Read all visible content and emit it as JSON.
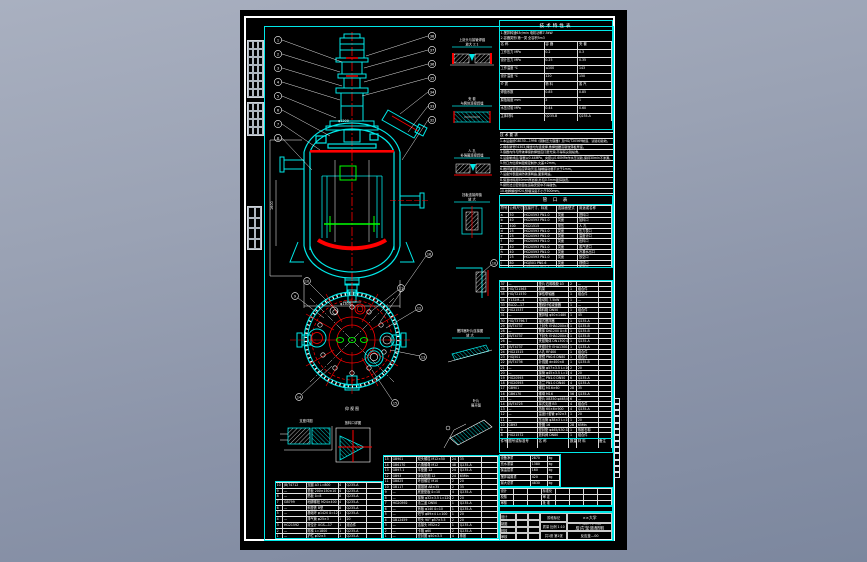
{
  "sheet": {
    "bg": "#000000",
    "accent": "#00e8e8",
    "line_white": "#ffffff",
    "line_red": "#ff0000",
    "line_green": "#00ff00"
  },
  "tech_table": {
    "title": "技术特性表",
    "note1": "1.搅拌转速63r/min  电机功率7.5kW",
    "note2": "2.容器类别:第一类  全容积5m3",
    "headers": [
      "名    称",
      "容  器",
      "夹  套"
    ],
    "rows": [
      [
        "工作压力 MPa",
        "0.2",
        "0.3"
      ],
      [
        "设计压力 MPa",
        "0.25",
        "0.35"
      ],
      [
        "工作温度 ℃",
        "≤100",
        "143"
      ],
      [
        "设计温度 ℃",
        "120",
        "150"
      ],
      [
        "介  质",
        "物 料",
        "蒸 汽"
      ],
      [
        "焊缝系数",
        "0.85",
        "0.85"
      ],
      [
        "腐蚀裕度 mm",
        "2",
        "1"
      ],
      [
        "水压试验 MPa",
        "0.44",
        "0.60"
      ],
      [
        "主体材料",
        "Q235-B",
        "Q235-A"
      ]
    ]
  },
  "notes": {
    "lines": [
      "技 术 要 求",
      "1.本设备按GB150—1998《钢制压力容器》及HG/T20569制造、试验和验收。",
      "2.焊条牌号E4303,焊缝均为连续焊,角焊缝腰高取较薄板厚度。",
      "3.容器内件与筒体焊接的焊缝应打磨光滑,不得有尖锐棱角。",
      "4.设备制成后,容器以0.44MPa、夹套以0.60MPa作水压试验,保持30min不渗漏。",
      "5.管口方位按本图规定制作,允差±2mm。",
      "6.搅拌轴安装后应转动灵活,轴端摆动量不大于1mm。",
      "7.设备外表面涂防锈漆两遍,面漆两遍。",
      "8.保温材料用50mm厚岩棉,外包0.5mm镀锌铁皮。",
      "9.接管法兰密封面在运输安装中不得碰伤。",
      "10.地脚螺栓M24,预埋深度不小于300mm。",
      "11.设备安装验收按GB50231—98执行。"
    ]
  },
  "nozzle_table": {
    "title": "管 口 表",
    "headers": [
      "符号",
      "公称尺寸",
      "连接尺寸、标准",
      "连接面型式",
      "用途或名称"
    ],
    "rows": [
      [
        "a",
        "50",
        "HG20593  PN1.0",
        "突面",
        "进料口"
      ],
      [
        "b",
        "40",
        "HG20593  PN1.0",
        "突面",
        "加料口"
      ],
      [
        "c",
        "400",
        "HG21515",
        "常压",
        "人  孔"
      ],
      [
        "d",
        "25",
        "HG20593  PN1.0",
        "突面",
        "压力表口"
      ],
      [
        "e",
        "25",
        "HG20593  PN1.0",
        "突面",
        "温度计口"
      ],
      [
        "f",
        "80",
        "HG20593  PN1.0",
        "突面",
        "出料口"
      ],
      [
        "g",
        "40",
        "HG20593  PN1.0",
        "突面",
        "蒸汽进口"
      ],
      [
        "h",
        "40",
        "HG20593  PN1.0",
        "突面",
        "冷凝水出口"
      ],
      [
        "i",
        "25",
        "HG20593  PN1.0",
        "突面",
        "放空口"
      ],
      [
        "j",
        "80",
        "HGJ501  PN0.6",
        "突面",
        "视镜口"
      ],
      [
        "k",
        "25",
        "HG20593  PN1.0",
        "突面",
        "备用口"
      ]
    ]
  },
  "bom_right": {
    "header": [
      "件号",
      "图号或标准号",
      "名   称",
      "数量",
      "材  料",
      "备注"
    ],
    "rows": [
      [
        "37",
        "—",
        "垫片 石棉橡胶 δ3",
        "2",
        "—",
        ""
      ],
      [
        "36",
        "HG/T21563",
        "机架",
        "1",
        "组合件",
        ""
      ],
      [
        "35",
        "HG/T21570",
        "弹性联轴器",
        "1",
        "组合件",
        ""
      ],
      [
        "34",
        "Y132M—4",
        "电动机 7.5kW",
        "1",
        "—",
        ""
      ],
      [
        "33",
        "BLD2—17",
        "摆线针轮减速器",
        "1",
        "—",
        ""
      ],
      [
        "32",
        "HG21537",
        "填料箱 DN50",
        "1",
        "组合件",
        ""
      ],
      [
        "31",
        "—",
        "搅拌轴 φ50×1480",
        "1",
        "45",
        ""
      ],
      [
        "30",
        "HG/T3796.7",
        "锚式搅拌器",
        "1",
        "Q235-A",
        ""
      ],
      [
        "29",
        "JB/T4737",
        "上封头 EHA1200×8",
        "1",
        "Q235-B",
        ""
      ],
      [
        "28",
        "—",
        "筒体 DN1200 δ=8",
        "1",
        "Q235-B",
        ""
      ],
      [
        "27",
        "JB/T4737",
        "下封头 EHA1200×10",
        "1",
        "Q235-B",
        ""
      ],
      [
        "26",
        "—",
        "夹套筒体 DN1300 δ=6",
        "1",
        "Q235-A",
        ""
      ],
      [
        "25",
        "JB/T4737",
        "夹套封头 EHA1300×8",
        "1",
        "Q235-A",
        ""
      ],
      [
        "24",
        "HG21515",
        "人孔 RF400",
        "1",
        "组合件",
        ""
      ],
      [
        "23",
        "HGJ501",
        "视镜 PN0.6 DN80",
        "1",
        "组合件",
        ""
      ],
      [
        "22",
        "JB/T4736",
        "补强圈 dn400×8",
        "1",
        "Q235-B",
        ""
      ],
      [
        "21",
        "—",
        "接管 φ57×3.5 L=160",
        "2",
        "20",
        ""
      ],
      [
        "20",
        "—",
        "接管 φ45×3.5 L=150",
        "4",
        "20",
        ""
      ],
      [
        "19",
        "HG20593",
        "法兰 PN1.0 DN50",
        "6",
        "Q235-A",
        ""
      ],
      [
        "18",
        "HG20593",
        "法兰 PN1.0 DN40",
        "4",
        "Q235-A",
        ""
      ],
      [
        "17",
        "GB901",
        "螺柱 M16×60",
        "28",
        "35",
        ""
      ],
      [
        "16",
        "GB6170",
        "螺母 M16",
        "56",
        "Q235-A",
        ""
      ],
      [
        "15",
        "—",
        "垫片 XB350 φ465/430",
        "6",
        "—",
        ""
      ],
      [
        "14",
        "JB/T4725",
        "耳式支座 B3",
        "4",
        "组合件",
        ""
      ],
      [
        "13",
        "—",
        "挡板 60×6×900",
        "4",
        "Q235-A",
        ""
      ],
      [
        "12",
        "—",
        "温度计套管 φ32×3",
        "1",
        "20",
        ""
      ],
      [
        "11",
        "—",
        "压出管 φ38×3 L=1650",
        "1",
        "20",
        ""
      ],
      [
        "10",
        "GB93",
        "垫圈 16",
        "28",
        "65Mn",
        ""
      ],
      [
        "9",
        "—",
        "密封垫 φ465/430 δ2",
        "1",
        "橡胶石棉",
        ""
      ],
      [
        "8",
        "HG21572",
        "放料阀 DN80",
        "1",
        "组合件",
        ""
      ]
    ]
  },
  "bom_mid": {
    "rows": [
      [
        "15",
        "GB901",
        "双头螺柱 M12×50",
        "24",
        "35",
        ""
      ],
      [
        "14",
        "GB6170",
        "六角螺母 M12",
        "48",
        "Q235-A",
        ""
      ],
      [
        "13",
        "GB97.1",
        "平垫圈 12",
        "24",
        "Q235-A",
        ""
      ],
      [
        "12",
        "GB93",
        "弹簧垫圈 12",
        "24",
        "65Mn",
        ""
      ],
      [
        "11",
        "GB825",
        "环首螺钉 M10",
        "2",
        "20",
        ""
      ],
      [
        "10",
        "GB117",
        "圆锥销 A8×35",
        "2",
        "35",
        ""
      ],
      [
        "9",
        "—",
        "底座垫板 δ=10",
        "4",
        "Q235-A",
        ""
      ],
      [
        "8",
        "—",
        "接管 φ32×3.5 L=120",
        "2",
        "20",
        ""
      ],
      [
        "7",
        "HG20592",
        "法兰盖 DN50",
        "1",
        "Q235-A",
        ""
      ],
      [
        "6",
        "—",
        "盲板 φ140 δ=10",
        "1",
        "Q235-A",
        ""
      ],
      [
        "5",
        "—",
        "短节 φ89×4 L=100",
        "1",
        "20",
        ""
      ],
      [
        "4",
        "GB12459",
        "弯头 90° φ57×3.5",
        "2",
        "20",
        ""
      ],
      [
        "3",
        "—",
        "活接头 M52×2",
        "1",
        "Q235-A",
        ""
      ],
      [
        "2",
        "—",
        "卡箍 φ60",
        "2",
        "Q235-A",
        ""
      ],
      [
        "1",
        "—",
        "密封圈 φ50×3.5",
        "4",
        "橡胶",
        ""
      ]
    ]
  },
  "bom_left": {
    "rows": [
      [
        "10",
        "JB/T4712",
        "支腿 A3 L=800",
        "4",
        "Q235-A",
        ""
      ],
      [
        "9",
        "—",
        "垫板 200×150×10",
        "4",
        "Q235-A",
        ""
      ],
      [
        "8",
        "—",
        "筋板 δ=8",
        "8",
        "Q235-A",
        ""
      ],
      [
        "7",
        "GB799",
        "地脚螺栓 M24×400",
        "4",
        "Q235-A",
        ""
      ],
      [
        "6",
        "—",
        "斜垫铁 B型",
        "8",
        "Q235-A",
        ""
      ],
      [
        "5",
        "—",
        "基础环 φ1420 δ=12",
        "1",
        "Q235-A",
        ""
      ],
      [
        "4",
        "—",
        "排气管 φ25×3",
        "1",
        "20",
        ""
      ],
      [
        "3",
        "HG21592",
        "液位计 UGS—17",
        "1",
        "组合件",
        ""
      ],
      [
        "2",
        "—",
        "爬梯 L=1800",
        "1",
        "Q235-A",
        ""
      ],
      [
        "1",
        "—",
        "护栏 φ32×3",
        "1",
        "Q235-A",
        ""
      ]
    ]
  },
  "mass_table": {
    "rows": [
      [
        "设备净重",
        "2870",
        "kg"
      ],
      [
        "充水重量",
        "1380",
        "kg"
      ],
      [
        "保温层重",
        "160",
        "kg"
      ],
      [
        "搅拌装置重",
        "420",
        "kg"
      ],
      [
        "最大总重",
        "4830",
        "kg"
      ]
    ]
  },
  "sig_rows": {
    "rows": [
      [
        "设计",
        "",
        "",
        "标准化",
        "",
        "",
        "",
        ""
      ],
      [
        "校核",
        "",
        "",
        "审  定",
        "",
        "",
        "",
        ""
      ],
      [
        "审核",
        "",
        "",
        "批  准",
        "",
        "",
        "",
        ""
      ]
    ]
  },
  "rev_row": [
    "标记",
    "处数",
    "分区",
    "更改文件号",
    "签名",
    "年、月、日"
  ],
  "title_block": {
    "design_label": "设计",
    "draft_label": "制图",
    "check_label": "校核",
    "approve_label": "审核",
    "stage_label": "阶段标记",
    "mass_label": "质量",
    "scale_label": "比例",
    "scale": "1:10",
    "sheets": "共1张 第1张",
    "unit": "××大学",
    "title_line1": "带搅拌夹套",
    "title_line2": "反应釜装配图",
    "drawing_no": "反应釜—00"
  },
  "details": {
    "d1a": "上封头与接管焊缝",
    "d1b": "放大 2:1",
    "d2a": "夹 套",
    "d2b": "与筒体连接焊缝",
    "d3a": "人 孔",
    "d3b": "补强圈连接焊缝",
    "d4a": "挡板连接焊缝",
    "d4b": "放 大",
    "d5a": "支座",
    "d5b": "垫板焊缝",
    "d6a": "搅拌器叶片连接图",
    "d6b": "放 大",
    "d7a": "叶片",
    "d7b": "展开图",
    "dl1": "支座详图",
    "dl2": "放料口详图",
    "plan_label": "仰 视 图"
  },
  "balloons": {
    "left": [
      "1",
      "2",
      "3",
      "4",
      "5",
      "6",
      "7",
      "8"
    ],
    "right": [
      "38",
      "37",
      "36",
      "35",
      "34",
      "33",
      "32"
    ],
    "plan": [
      "9",
      "10",
      "11",
      "12",
      "13",
      "14",
      "15",
      "16"
    ],
    "detail": "10"
  },
  "dims": {
    "d1": "φ1200",
    "d2": "φ1300",
    "d3": "1600",
    "d4": "870"
  }
}
